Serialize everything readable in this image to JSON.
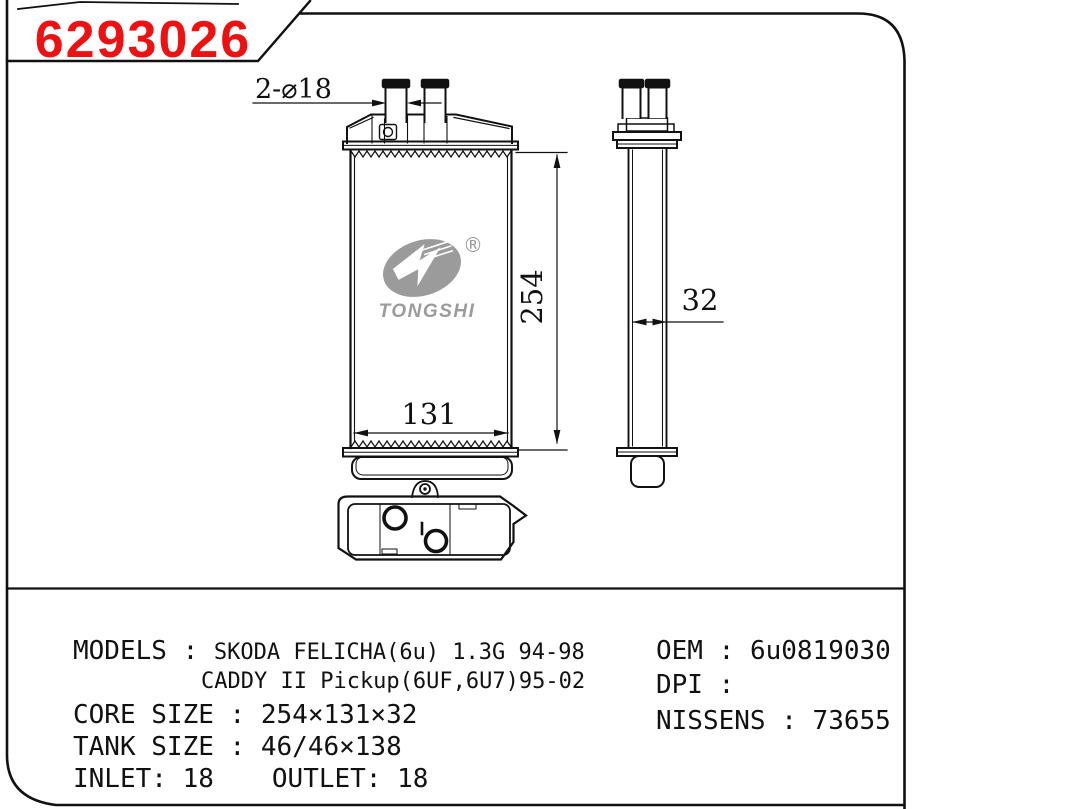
{
  "title_block": {
    "part_number": "6293026"
  },
  "colors": {
    "part_number_red": "#ee1111",
    "logo_gray": "#9b9b9b"
  },
  "front_view": {
    "dim_pipes": "2-⌀18",
    "dim_core_height": "254",
    "dim_core_width": "131"
  },
  "side_view": {
    "dim_core_depth": "32"
  },
  "logo": {
    "brand": "TONGSHI",
    "registered": "®"
  },
  "specs": {
    "sep": " : ",
    "models": {
      "label": "MODELS",
      "line1": "SKODA FELICHA(6u) 1.3G 94-98",
      "line2": "CADDY II Pickup(6UF,6U7)95-02"
    },
    "core_size": {
      "label": "CORE SIZE",
      "value": "254×131×32"
    },
    "tank_size": {
      "label": "TANK SIZE",
      "value": "46/46×138"
    },
    "inlet": {
      "label": "INLET:",
      "value": "18"
    },
    "outlet": {
      "label": "OUTLET:",
      "value": "18"
    },
    "oem": {
      "label": "OEM",
      "value": "6u0819030"
    },
    "dpi": {
      "label": "DPI",
      "value": ""
    },
    "nissens": {
      "label": "NISSENS",
      "value": "73655"
    }
  }
}
